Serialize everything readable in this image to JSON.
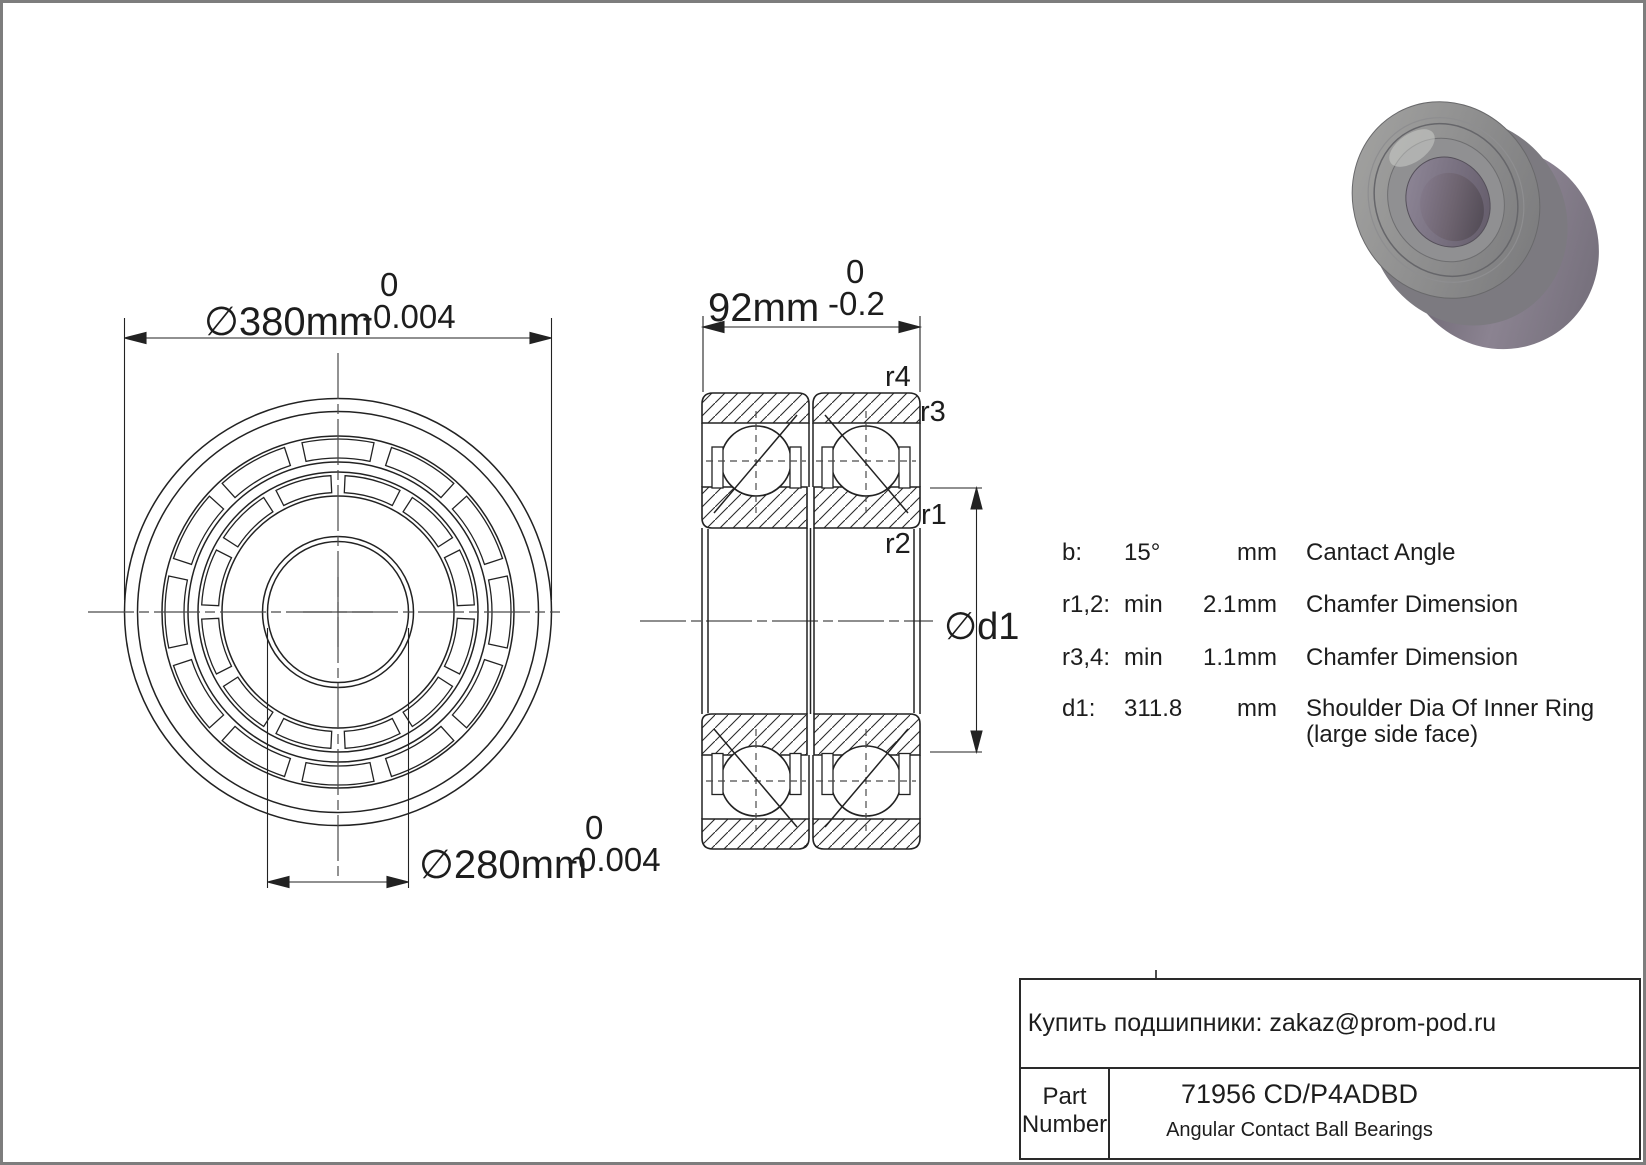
{
  "drawing": {
    "dim_outer": {
      "text": "∅380mm",
      "tol_top": "0",
      "tol_bottom": "-0.004"
    },
    "dim_bore": {
      "text": "∅280mm",
      "tol_top": "0",
      "tol_bottom": "-0.004"
    },
    "dim_width": {
      "text": "92mm",
      "tol_top": "0",
      "tol_bottom": "-0.2"
    },
    "dim_shoulder_label": "∅d1",
    "labels": {
      "r1": "r1",
      "r2": "r2",
      "r3": "r3",
      "r4": "r4"
    }
  },
  "spec_table": {
    "rows": [
      {
        "label": "b:",
        "min": "",
        "value": "15°",
        "unit": "mm",
        "desc": "Cantact Angle",
        "desc2": ""
      },
      {
        "label": "r1,2:",
        "min": "min",
        "value": "2.1",
        "unit": "mm",
        "desc": "Chamfer Dimension",
        "desc2": ""
      },
      {
        "label": "r3,4:",
        "min": "min",
        "value": "1.1",
        "unit": "mm",
        "desc": "Chamfer Dimension",
        "desc2": ""
      },
      {
        "label": "d1:",
        "min": "",
        "value": "311.8",
        "unit": "mm",
        "desc": "Shoulder Dia Of Inner Ring",
        "desc2": "(large side face)"
      }
    ]
  },
  "title_block": {
    "contact_line": "Купить подшипники: zakaz@prom-pod.ru",
    "part_label_line1": "Part",
    "part_label_line2": "Number",
    "part_number": "71956 CD/P4ADBD",
    "category": "Angular Contact Ball Bearings"
  },
  "colors": {
    "line": "#222222",
    "centerline": "#4a4a4a",
    "page_border": "#7d7d7d",
    "metal_light": "#a2a2a0",
    "metal_mid": "#7c7a80",
    "metal_dark": "#55505a",
    "bore_purple": "#6e6470"
  }
}
